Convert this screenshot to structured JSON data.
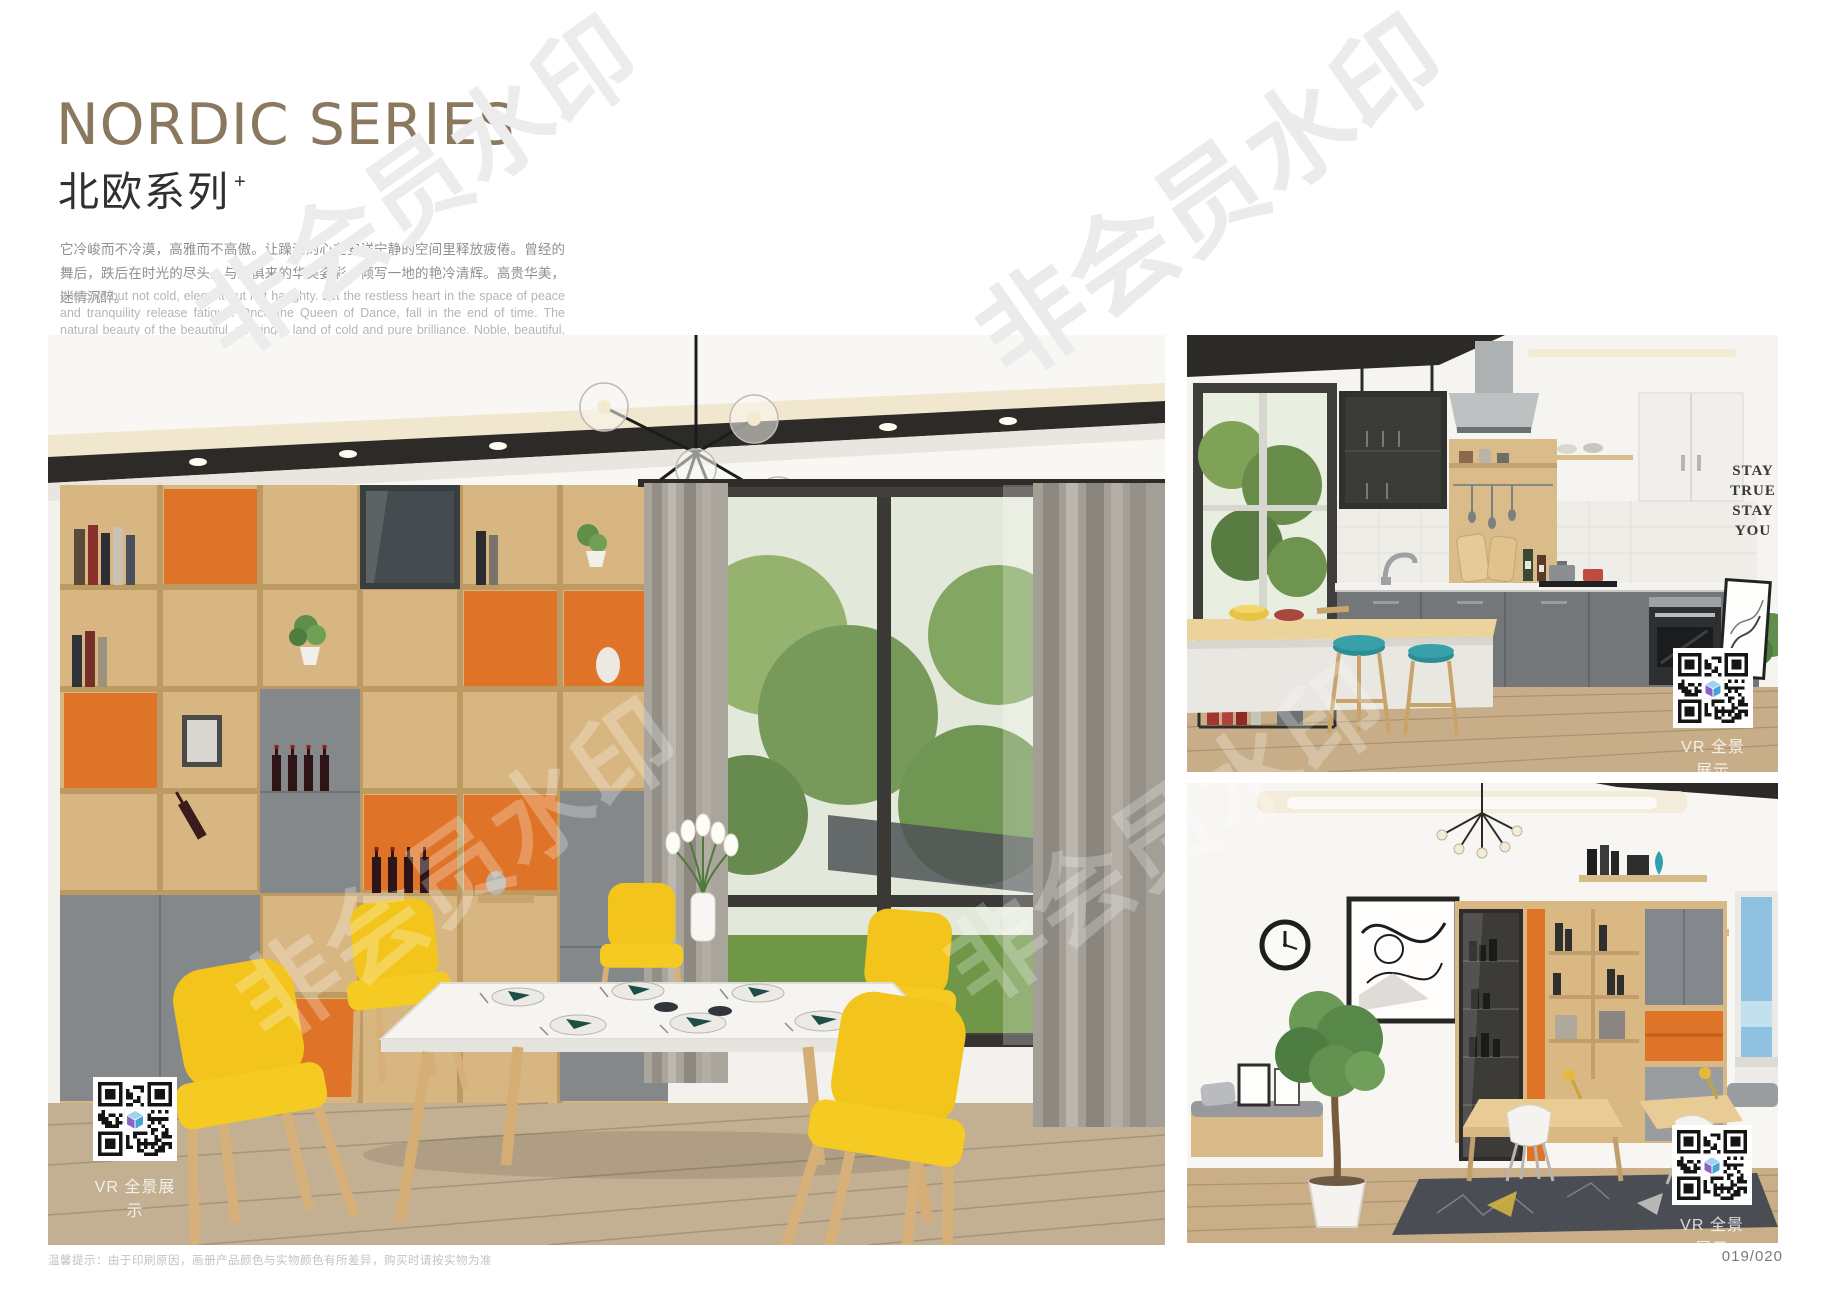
{
  "header": {
    "title_en": "NORDIC SERIES",
    "title_cn": "北欧系列",
    "title_sup": "+",
    "desc_cn": "它冷峻而不冷漠，高雅而不高傲。让躁动的心在安详宁静的空间里释放疲倦。曾经的舞后，跌后在时光的尽头。与生俱来的华美姿彩，倾写一地的艳冷清辉。高贵华美，迷情沉醉。",
    "desc_en": "It is cold but not cold, elegant but not haughty. Let the restless heart in the space of peace and tranquility release fatigue. Once the Queen of Dance, fall in the end of time. The natural beauty of the beautiful, pouring a land of cold and pure brilliance. Noble, beautiful, enchanted."
  },
  "vr_label": "VR 全景展示",
  "photos": {
    "dining": {
      "name": "北欧系列餐厅场景"
    },
    "kitchen": {
      "name": "北欧系列厨房场景",
      "decal": [
        "STAY",
        "TRUE",
        "STAY",
        "YOU"
      ]
    },
    "study": {
      "name": "北欧系列书房场景"
    }
  },
  "watermark": {
    "text": "非会员水印"
  },
  "footer": {
    "note": "温馨提示：由于印刷原因，画册产品颜色与实物颜色有所差异，购买时请按实物为准",
    "page_number": "019/020"
  },
  "colors": {
    "title": "#8A795E",
    "accent_orange": "#DF7427",
    "accent_yellow": "#F2C51D",
    "cabinet_gray": "#84878B",
    "watermark_gray": "#EBEBEB"
  }
}
